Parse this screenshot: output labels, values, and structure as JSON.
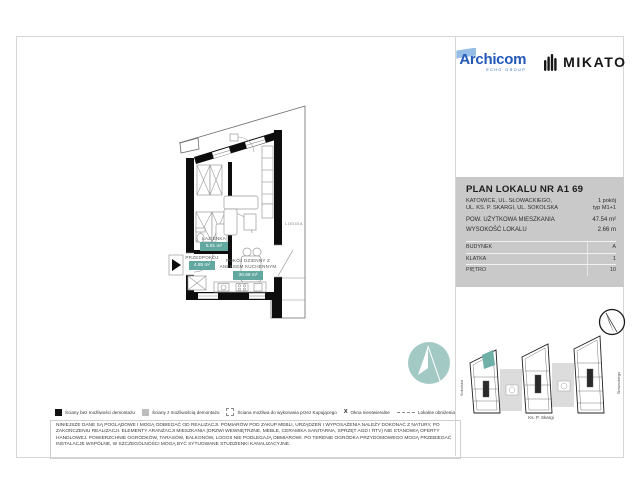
{
  "brand": {
    "archicom": "Archicom",
    "archicom_sub": "ECHO GROUP",
    "mikato": "MIKATO"
  },
  "info_panel": {
    "title": "PLAN LOKALU NR A1 69",
    "address_line1": "KATOWICE, UL. SŁOWACKIEGO,",
    "address_line2": "UL. KS. P. SKARGI, UL. SOKOLSKA",
    "rooms_count": "1 pokój",
    "unit_type": "typ M1+1",
    "area_label": "POW. UŻYTKOWA MIESZKANIA",
    "area_value": "47.54 m²",
    "height_label": "WYSOKOŚĆ LOKALU",
    "height_value": "2.66 m",
    "table": {
      "rows": [
        {
          "label": "BUDYNEK",
          "value": "A"
        },
        {
          "label": "KLATKA",
          "value": "1"
        },
        {
          "label": "PIĘTRO",
          "value": "10"
        }
      ]
    }
  },
  "plan": {
    "rooms": {
      "bathroom": {
        "name": "ŁAZIENKA",
        "area": "5.81 m²"
      },
      "hall": {
        "name": "PRZEDPOKÓJ",
        "area": "4.85 m²"
      },
      "living": {
        "name_line1": "POKÓJ DZIENNY Z",
        "name_line2": "ANEKSEM KUCHENNYM",
        "area": "36.68 m²"
      },
      "loggia": {
        "name": "LOGGIA"
      }
    }
  },
  "site_map": {
    "street_bottom": "Ks. P. Skargi",
    "street_left": "Sokolska",
    "street_right": "Słowackiego"
  },
  "legend": {
    "items": [
      {
        "symbol": "black-square",
        "label": "Ściany bez możliwości demontażu"
      },
      {
        "symbol": "gray-square",
        "label": "Ściany z możliwością demontażu"
      },
      {
        "symbol": "dashed-square",
        "label": "Ściana możliwa do wykonania przez Kupującego"
      },
      {
        "symbol": "x",
        "symbol_text": "X",
        "label": "Okna nieotwieralne"
      },
      {
        "symbol": "dashed-line",
        "label": "Lokalne obniżenia"
      }
    ]
  },
  "disclaimer": "NINIEJSZE DANE SĄ POGLĄDOWE I MOGĄ ODBIEGAĆ OD REALIZACJI. POMIARÓW POD ZAKUP MEBLI, URZĄDZEŃ I WYPOSAŻENIA NALEŻY DOKONAĆ Z NATURY, PO ZAKOŃCZENIU REALIZACJI. ELEMENTY ARANŻACJI MIESZKANIA (DRZWI WEWNĘTRZNE, MEBLE, CERAMIKA SANITARNA, SPRZĘT AGD I RTV) NIE STANOWIĄ OFERTY HANDLOWEJ. POWIERZCHNIE OGRÓDKÓW, TARASÓW, BALKONÓW, LOGGII NIE PODLEGAJĄ OBMIAROWI. PO TERENIE OGRÓDKA PRZYDOMOWEGO MOGĄ PRZEBIEGAĆ INSTALACJE WSPÓLNE, W SZCZEGÓLNOŚCI MOGĄ BYĆ SYTUOWANE STUDZIENKI KANALIZACYJNE.",
  "colors": {
    "teal_chip": "#62a8a1",
    "teal_compass": "#a3c9c5",
    "teal_unit": "#6fb0a9",
    "archicom_blue": "#2258b8",
    "panel_gray": "#c9c9c9",
    "wall_black": "#0d0d0d"
  }
}
